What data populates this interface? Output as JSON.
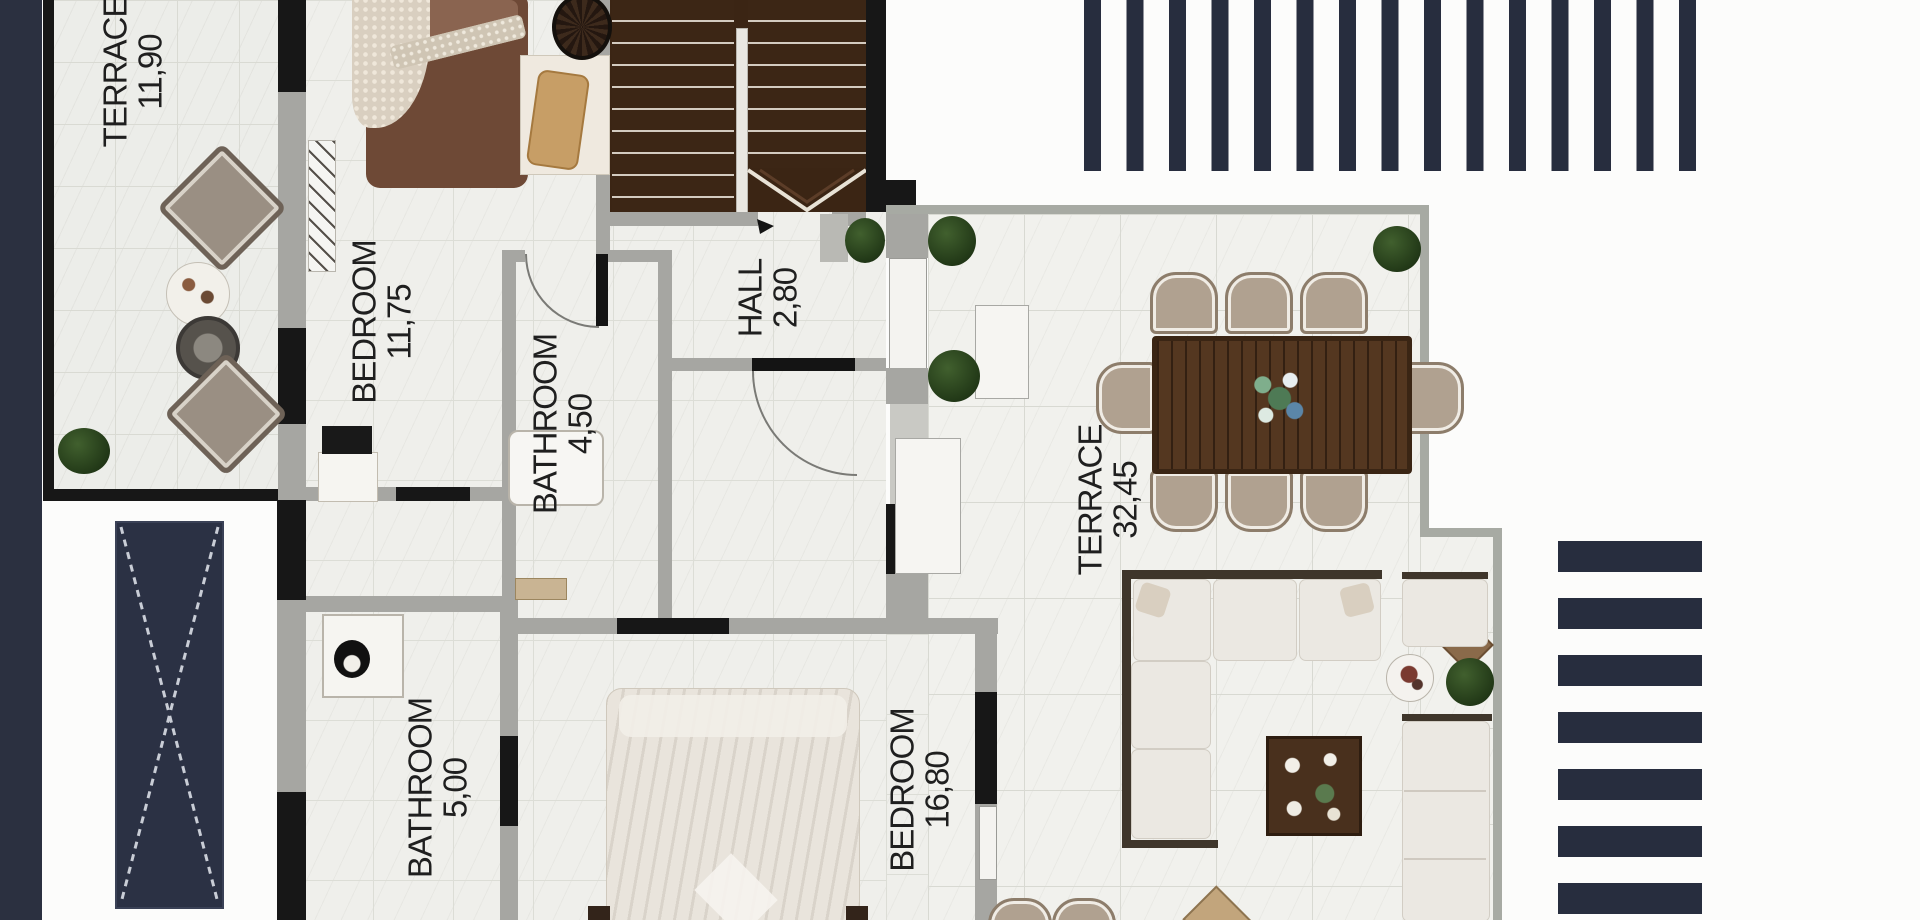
{
  "plan": {
    "rooms": [
      {
        "name": "TERRACE",
        "area": "11,90"
      },
      {
        "name": "BEDROOM",
        "area": "11,75"
      },
      {
        "name": "BATHROOM",
        "area": "4,50"
      },
      {
        "name": "HALL",
        "area": "2,80"
      },
      {
        "name": "TERRACE",
        "area": "32,45"
      },
      {
        "name": "BATHROOM",
        "area": "5,00"
      },
      {
        "name": "BEDROOM",
        "area": "16,80"
      }
    ],
    "colors": {
      "accent_navy": "#2b3040",
      "wall_black": "#171717",
      "wall_gray": "#a6a6a2",
      "stair_wood": "#3b2514",
      "table_wood": "#543720",
      "plant_green": "#2c4420",
      "floor_tile": "#ecede9"
    }
  }
}
